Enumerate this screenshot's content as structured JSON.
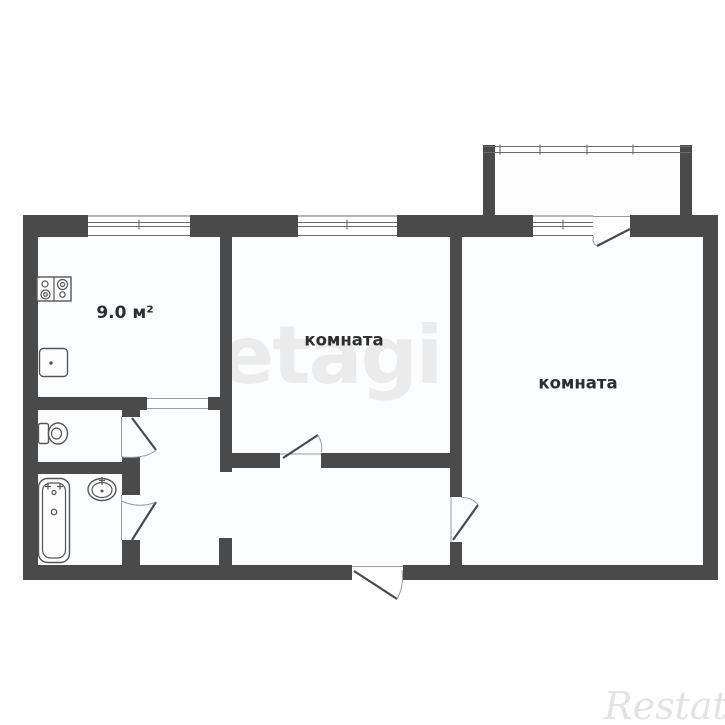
{
  "canvas": {
    "width": 725,
    "height": 725
  },
  "colors": {
    "background": "#ffffff",
    "wall": "#4a4a4a",
    "floor": "#fbfcfd",
    "label": "#2e2e2e",
    "thin": "#6b6b6b",
    "arc": "#9a9a9a",
    "fixture": "#555555",
    "fixture_fill": "#fdfdfe",
    "watermark_center": "#ebebeb",
    "watermark_restate": "#e3e3e3"
  },
  "labels": {
    "kitchen_area": "9.0 м²",
    "room_middle": "комната",
    "room_right": "комната"
  },
  "watermarks": {
    "center": "etagi",
    "bottom_right": "Restate"
  },
  "fixtures": [
    "stove-icon",
    "kitchen-sink-icon",
    "toilet-icon",
    "bathtub-icon",
    "washbasin-icon"
  ]
}
